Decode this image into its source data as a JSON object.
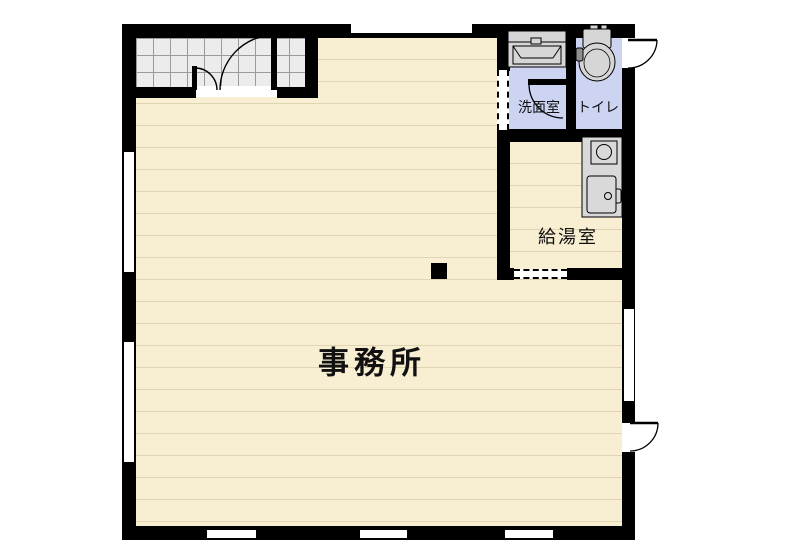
{
  "floorplan": {
    "rooms": {
      "office": {
        "label": "事務所"
      },
      "washroom": {
        "label": "洗面室"
      },
      "toilet": {
        "label": "トイレ"
      },
      "kitchenette": {
        "label": "給湯室"
      }
    },
    "fixtures": [
      {
        "name": "entry-double-door"
      },
      {
        "name": "vanity-sink"
      },
      {
        "name": "toilet-bowl"
      },
      {
        "name": "kitchen-counter-sink"
      },
      {
        "name": "water-heater-unit"
      },
      {
        "name": "pillar"
      }
    ],
    "colors": {
      "wall": "#000000",
      "office_floor": "#f8eed1",
      "floor_stripe": "#e0d5b2",
      "wet_room_floor": "#ccd4f2",
      "entry_tile": "#ececec",
      "tile_line": "#9a9a9a",
      "fixture_gray": "#d6d6d6"
    }
  }
}
